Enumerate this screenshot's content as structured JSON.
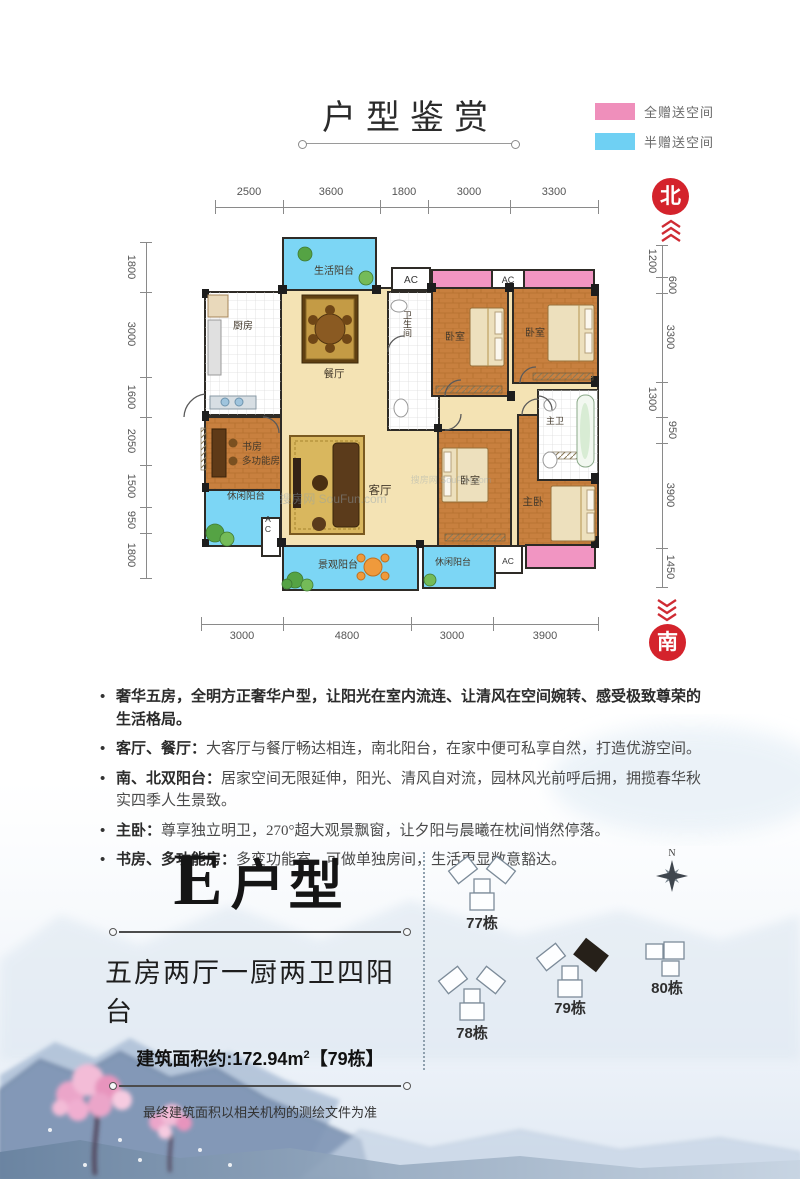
{
  "header": {
    "title": "户型鉴赏"
  },
  "legend": {
    "full": {
      "label": "全赠送空间",
      "color": "#ef8fbb"
    },
    "half": {
      "label": "半赠送空间",
      "color": "#6fd0f3"
    }
  },
  "compass": {
    "north": "北",
    "south": "南",
    "n_letter": "N"
  },
  "dimensions": {
    "top": [
      "2500",
      "3600",
      "1800",
      "3000",
      "3300"
    ],
    "bottom": [
      "3000",
      "4800",
      "3000",
      "3900"
    ],
    "left": [
      "1800",
      "3000",
      "1600",
      "2050",
      "1500",
      "950",
      "1800"
    ],
    "right": [
      "1200",
      "600",
      "3300",
      "1300",
      "950",
      "3900",
      "1450"
    ]
  },
  "floorplan": {
    "rooms": {
      "life_balcony": "生活阳台",
      "kitchen": "厨房",
      "dining": "餐厅",
      "bath": "卫生间",
      "bedroom_a": "卧室",
      "bedroom_b": "卧室",
      "master_bath": "主卫",
      "study_line1": "书房",
      "study_line2": "多功能房",
      "leisure_balcony_a": "休闲阳台",
      "living": "客厅",
      "bedroom_c": "卧室",
      "master_bedroom": "主卧",
      "view_balcony": "景观阳台",
      "leisure_balcony_b": "休闲阳台",
      "ac": "AC"
    },
    "watermark": "搜房网 SouFun.com"
  },
  "features": [
    {
      "strong": "奢华五房，全明方正奢华户型，让阳光在室内流连、让清风在空间婉转、感受极致尊荣的生活格局。",
      "text": ""
    },
    {
      "strong": "客厅、餐厅：",
      "text": "大客厅与餐厅畅达相连，南北阳台，在家中便可私享自然，打造优游空间。"
    },
    {
      "strong": "南、北双阳台：",
      "text": "居家空间无限延伸，阳光、清风自对流，园林风光前呼后拥，拥揽春华秋实四季人生景致。"
    },
    {
      "strong": "主卧：",
      "text": "尊享独立明卫，270°超大观景飘窗，让夕阳与晨曦在枕间悄然停落。"
    },
    {
      "strong": "书房、多功能房：",
      "text": "多变功能室，可做单独房间，生活更显敞意豁达。"
    }
  ],
  "unit": {
    "name_letter": "E",
    "name_suffix": "户型",
    "layout": "五房两厅一厨两卫四阳台",
    "area_prefix": "建筑面积约:172.94m",
    "area_sup": "2",
    "area_suffix": "【79栋】",
    "disclaimer": "最终建筑面积以相关机构的测绘文件为准"
  },
  "site": {
    "buildings": [
      {
        "label": "77栋"
      },
      {
        "label": "78栋"
      },
      {
        "label": "79栋"
      },
      {
        "label": "80栋"
      }
    ]
  }
}
